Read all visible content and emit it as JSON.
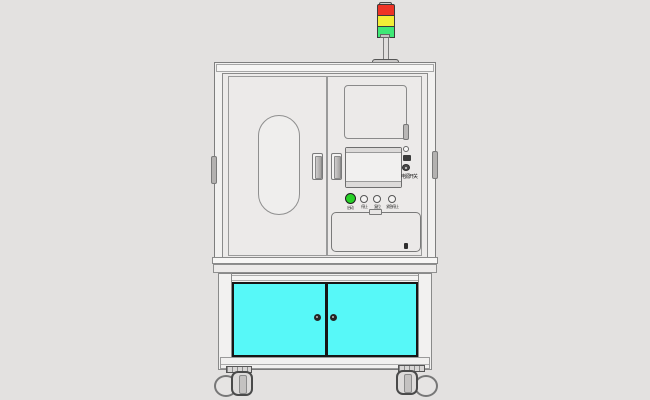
{
  "canvas": {
    "background": "#e3e1e0"
  },
  "signal_tower": {
    "lights": [
      {
        "name": "red-light",
        "color": "#ee3326"
      },
      {
        "name": "yellow-light",
        "color": "#f2ee36"
      },
      {
        "name": "green-light",
        "color": "#3fe876"
      }
    ]
  },
  "upper_cabinet": {
    "body_color": "#edebea",
    "outline_color": "#8a8a8a"
  },
  "control_panel": {
    "power_switch_label": "电源开关",
    "buttons": [
      {
        "name": "start-button",
        "label": "启动",
        "color": "#27d127"
      },
      {
        "name": "stop-button",
        "label": "停止",
        "color": "#f4f3f2"
      },
      {
        "name": "reset-button",
        "label": "复位",
        "color": "#f4f3f2"
      },
      {
        "name": "estop-button",
        "label": "紧急停止",
        "color": "#f4f3f2"
      }
    ]
  },
  "lower_cabinet": {
    "door_color": "#57f8f8"
  }
}
